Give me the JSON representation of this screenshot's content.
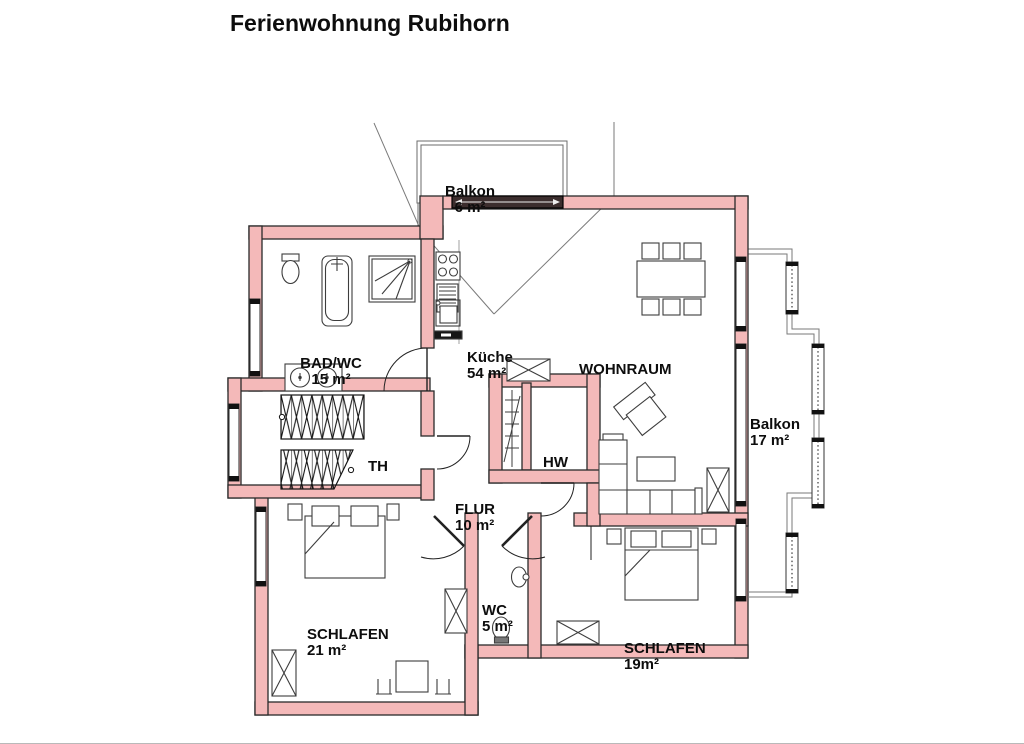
{
  "title": "Ferienwohnung Rubihorn",
  "colors": {
    "wall_fill": "#f4b9b9",
    "wall_stroke": "#2a2a2a",
    "furniture_line": "#3d3d3d",
    "thin_line": "#7a7a7a",
    "text": "#0d0d0d",
    "door_bar": "#3c2e2e"
  },
  "rooms": [
    {
      "id": "balkon-nord",
      "name": "Balkon",
      "area": "6 m²"
    },
    {
      "id": "bad-wc",
      "name": "BAD/WC",
      "area": "15 m²"
    },
    {
      "id": "kueche",
      "name": "Küche",
      "area": "54 m²"
    },
    {
      "id": "wohnraum",
      "name": "WOHNRAUM",
      "area": ""
    },
    {
      "id": "balkon-ost",
      "name": "Balkon",
      "area": "17 m²"
    },
    {
      "id": "th",
      "name": "TH",
      "area": ""
    },
    {
      "id": "flur",
      "name": "FLUR",
      "area": "10 m²"
    },
    {
      "id": "hw",
      "name": "HW",
      "area": ""
    },
    {
      "id": "schlafen-west",
      "name": "SCHLAFEN",
      "area": "21 m²"
    },
    {
      "id": "wc",
      "name": "WC",
      "area": "5 m²"
    },
    {
      "id": "schlafen-ost",
      "name": "SCHLAFEN",
      "area": "19m²"
    }
  ]
}
